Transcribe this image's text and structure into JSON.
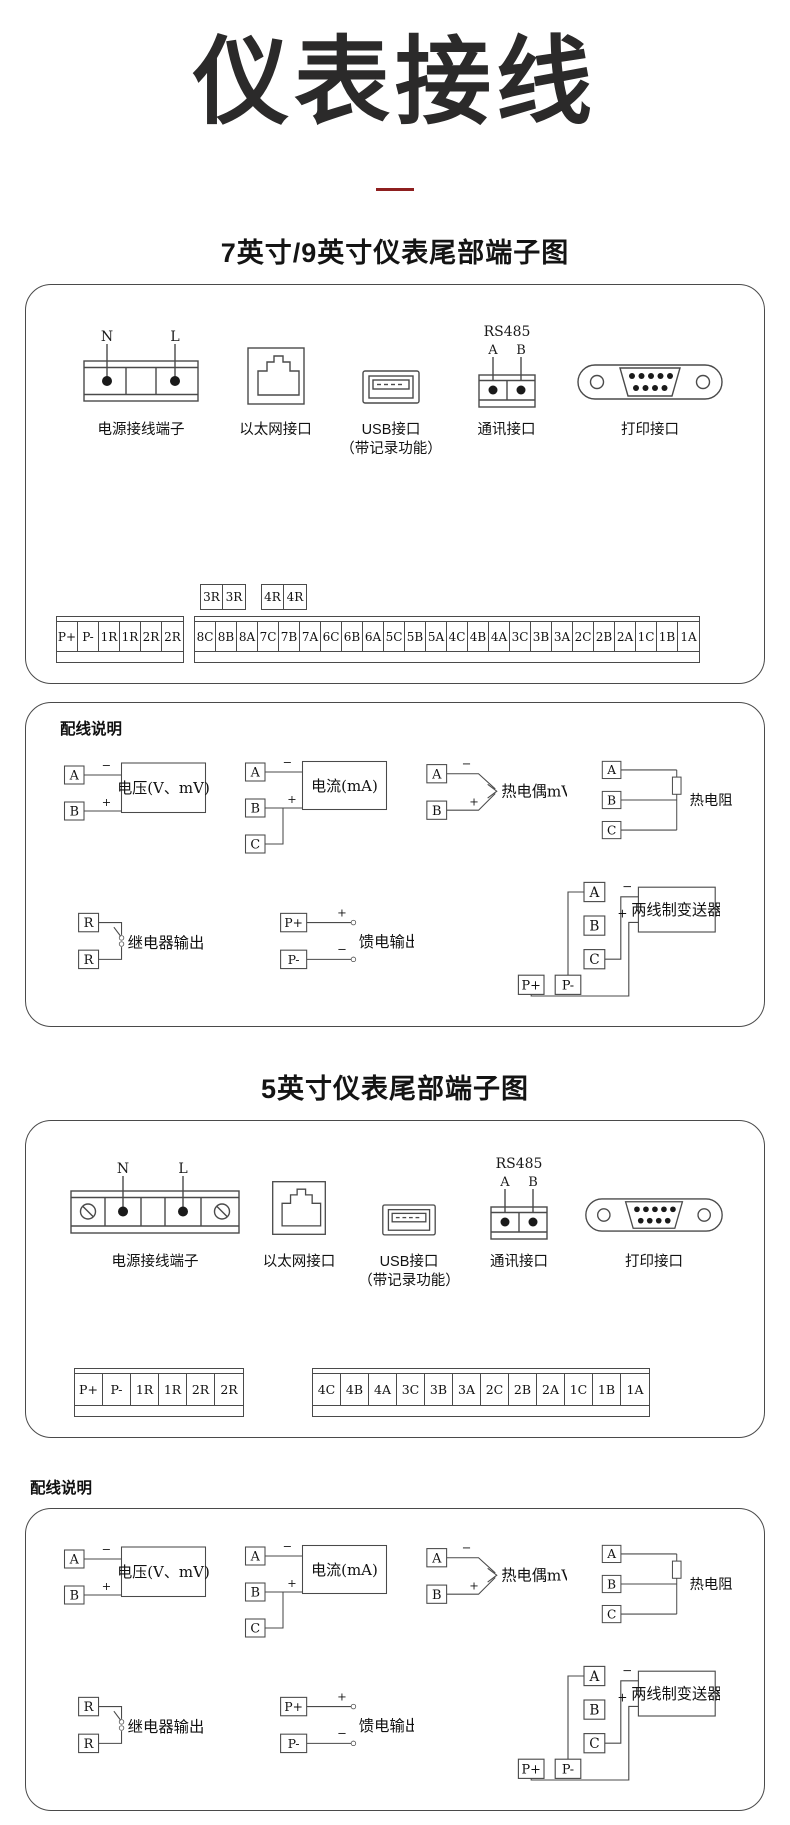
{
  "page": {
    "title": "仪表接线"
  },
  "sections": {
    "s79": {
      "heading": "7英寸/9英寸仪表尾部端子图",
      "ports": {
        "power": {
          "label": "电源接线端子",
          "n": "N",
          "l": "L"
        },
        "ethernet": {
          "label": "以太网接口"
        },
        "usb": {
          "label": "USB接口",
          "sublabel": "（带记录功能）"
        },
        "comm": {
          "label": "通讯接口",
          "protocol": "RS485",
          "a": "A",
          "b": "B"
        },
        "print": {
          "label": "打印接口"
        }
      },
      "terminals": {
        "relay_row_a": [
          "3R",
          "3R"
        ],
        "relay_row_b": [
          "4R",
          "4R"
        ],
        "left_strip": [
          "P+",
          "P-",
          "1R",
          "1R",
          "2R",
          "2R"
        ],
        "right_strip": [
          "8C",
          "8B",
          "8A",
          "7C",
          "7B",
          "7A",
          "6C",
          "6B",
          "6A",
          "5C",
          "5B",
          "5A",
          "4C",
          "4B",
          "4A",
          "3C",
          "3B",
          "3A",
          "2C",
          "2B",
          "2A",
          "1C",
          "1B",
          "1A"
        ]
      }
    },
    "s5": {
      "heading": "5英寸仪表尾部端子图",
      "ports": {
        "power": {
          "label": "电源接线端子",
          "n": "N",
          "l": "L"
        },
        "ethernet": {
          "label": "以太网接口"
        },
        "usb": {
          "label": "USB接口",
          "sublabel": "（带记录功能）"
        },
        "comm": {
          "label": "通讯接口",
          "protocol": "RS485",
          "a": "A",
          "b": "B"
        },
        "print": {
          "label": "打印接口"
        }
      },
      "terminals": {
        "left_strip": [
          "P+",
          "P-",
          "1R",
          "1R",
          "2R",
          "2R"
        ],
        "right_strip": [
          "4C",
          "4B",
          "4A",
          "3C",
          "3B",
          "3A",
          "2C",
          "2B",
          "2A",
          "1C",
          "1B",
          "1A"
        ]
      }
    }
  },
  "wiring": {
    "heading": "配线说明",
    "voltage": {
      "a": "A",
      "b": "B",
      "minus": "−",
      "plus": "+",
      "label": "电压(V、mV)"
    },
    "current": {
      "a": "A",
      "b": "B",
      "c": "C",
      "minus": "−",
      "plus": "+",
      "label": "电流(mA)"
    },
    "thermocouple": {
      "a": "A",
      "b": "B",
      "minus": "−",
      "plus": "+",
      "label": "热电偶mV"
    },
    "rtd": {
      "a": "A",
      "b": "B",
      "c": "C",
      "label": "热电阻"
    },
    "relay": {
      "r1": "R",
      "r2": "R",
      "label": "继电器输出"
    },
    "feed": {
      "pplus": "P+",
      "pminus": "P-",
      "plus": "+",
      "minus": "−",
      "label": "馈电输出"
    },
    "transmitter": {
      "a": "A",
      "b": "B",
      "c": "C",
      "pplus": "P+",
      "pminus": "P-",
      "plus": "+",
      "minus": "−",
      "label": "两线制变送器"
    }
  }
}
